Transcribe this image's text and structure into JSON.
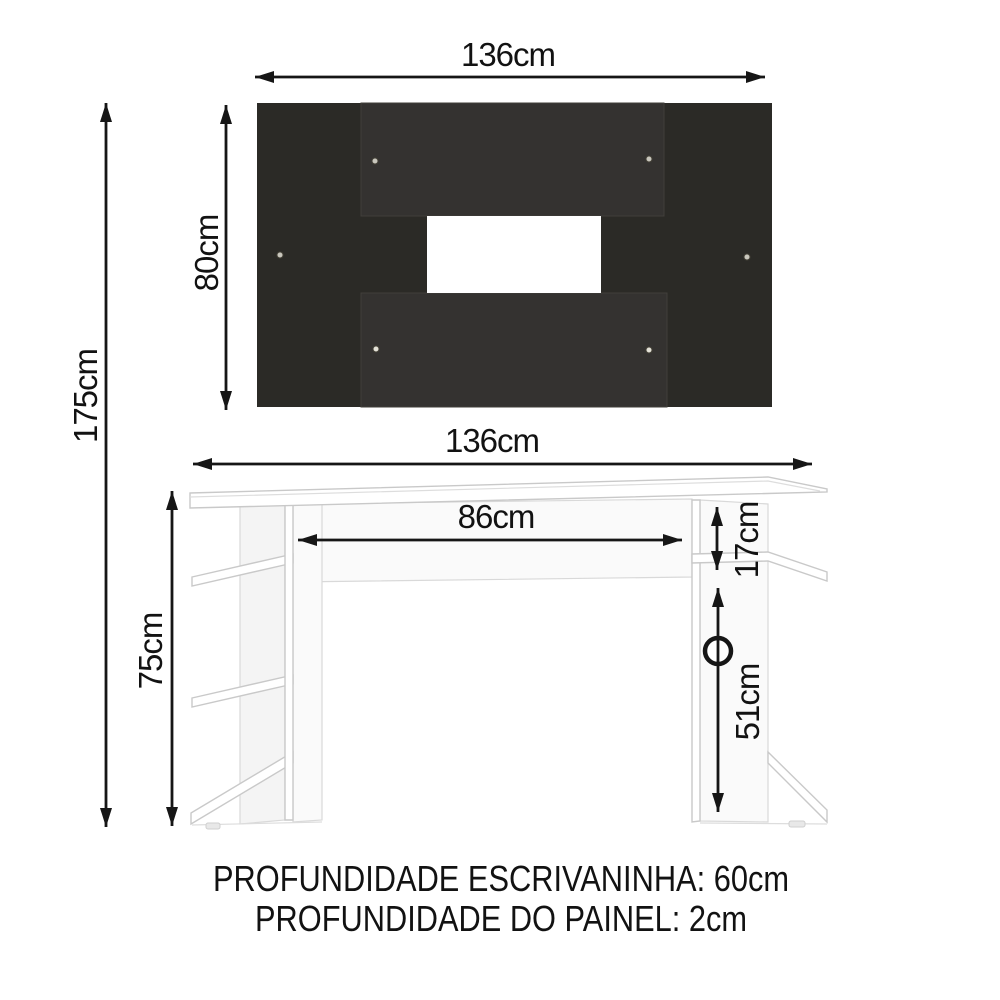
{
  "diagram": {
    "panel": {
      "width_label": "136cm",
      "height_label": "80cm"
    },
    "desk": {
      "width_label": "136cm",
      "inner_width_label": "86cm",
      "height_label": "75cm",
      "shelf_gap_label": "17cm",
      "side_opening_label": "51cm"
    },
    "total_height_label": "175cm",
    "footer": {
      "line1": "PROFUNDIDADE ESCRIVANINHA: 60cm",
      "line2": "PROFUNDIDADE DO PAINEL: 2cm"
    },
    "colors": {
      "panel_dark": "#2b2a26",
      "panel_overlay": "#343230",
      "cutout": "#ffffff",
      "dimension_line": "#161616"
    }
  }
}
